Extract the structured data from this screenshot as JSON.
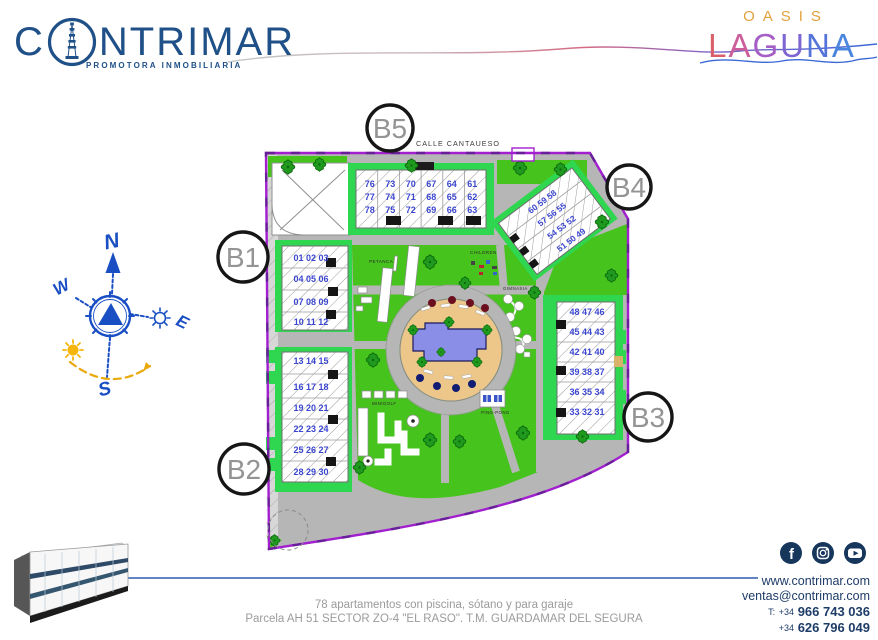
{
  "header": {
    "brand": {
      "prefix": "C",
      "suffix": "NTRIMAR",
      "tagline": "PROMOTORA INMOBILIARIA"
    },
    "project": {
      "top": "OASIS",
      "letters": [
        "L",
        "A",
        "G",
        "U",
        "N",
        "A"
      ]
    }
  },
  "compass": {
    "north": "N",
    "south": "S",
    "east": "E",
    "west": "W"
  },
  "plan": {
    "street": "CALLE CANTAUESO",
    "badges": {
      "b1": "B1",
      "b2": "B2",
      "b3": "B3",
      "b4": "B4",
      "b5": "B5"
    },
    "amenities": {
      "petanca": "PETANCA",
      "children": "CHILDREN",
      "gym": "GIMNASIA",
      "minigolf": "MINIGOLF",
      "pingpong": "PING-PONG"
    },
    "blocks": {
      "b5": {
        "rows": [
          "76 73 70 67 64 61",
          "77 74 71 68 65 62",
          "78 75 72 69 66 63"
        ]
      },
      "b4": {
        "rows": [
          "60 59 58",
          "57 56 55",
          "54 53 52",
          "51 50 49"
        ]
      },
      "b1": {
        "rows": [
          "01 02 03",
          "04 05 06",
          "07 08 09",
          "10 11 12"
        ]
      },
      "b2": {
        "rows": [
          "13 14 15",
          "16 17 18",
          "19 20 21",
          "22 23 24",
          "25 26 27",
          "28 29 30"
        ]
      },
      "b3": {
        "rows": [
          "48 47 46",
          "45 44 43",
          "42 41 40",
          "39 38 37",
          "36 35 34",
          "33 32 31"
        ]
      }
    }
  },
  "footer": {
    "line1": "78 apartamentos con piscina, sótano y para garaje",
    "line2": "Parcela AH 51 SECTOR ZO-4 \"EL RASO\". T.M. GUARDAMAR DEL SEGURA"
  },
  "contact": {
    "web": "www.contrimar.com",
    "email": "ventas@contrimar.com",
    "phone_label": "T:",
    "cc1": "+34",
    "phone1": "966 743 036",
    "cc2": "+34",
    "phone2": "626 796 049"
  },
  "colors": {
    "brand_blue": "#205088",
    "navy": "#1e3c68",
    "boundary_purple": "#a21fd0",
    "lawn_green": "#46c31c",
    "hedge_green": "#2fd64f",
    "pool_blue": "#8a8ee6",
    "deck_sand": "#edc78a",
    "unit_number_blue": "#3b46cf",
    "oasis_orange": "#e2a23b"
  }
}
